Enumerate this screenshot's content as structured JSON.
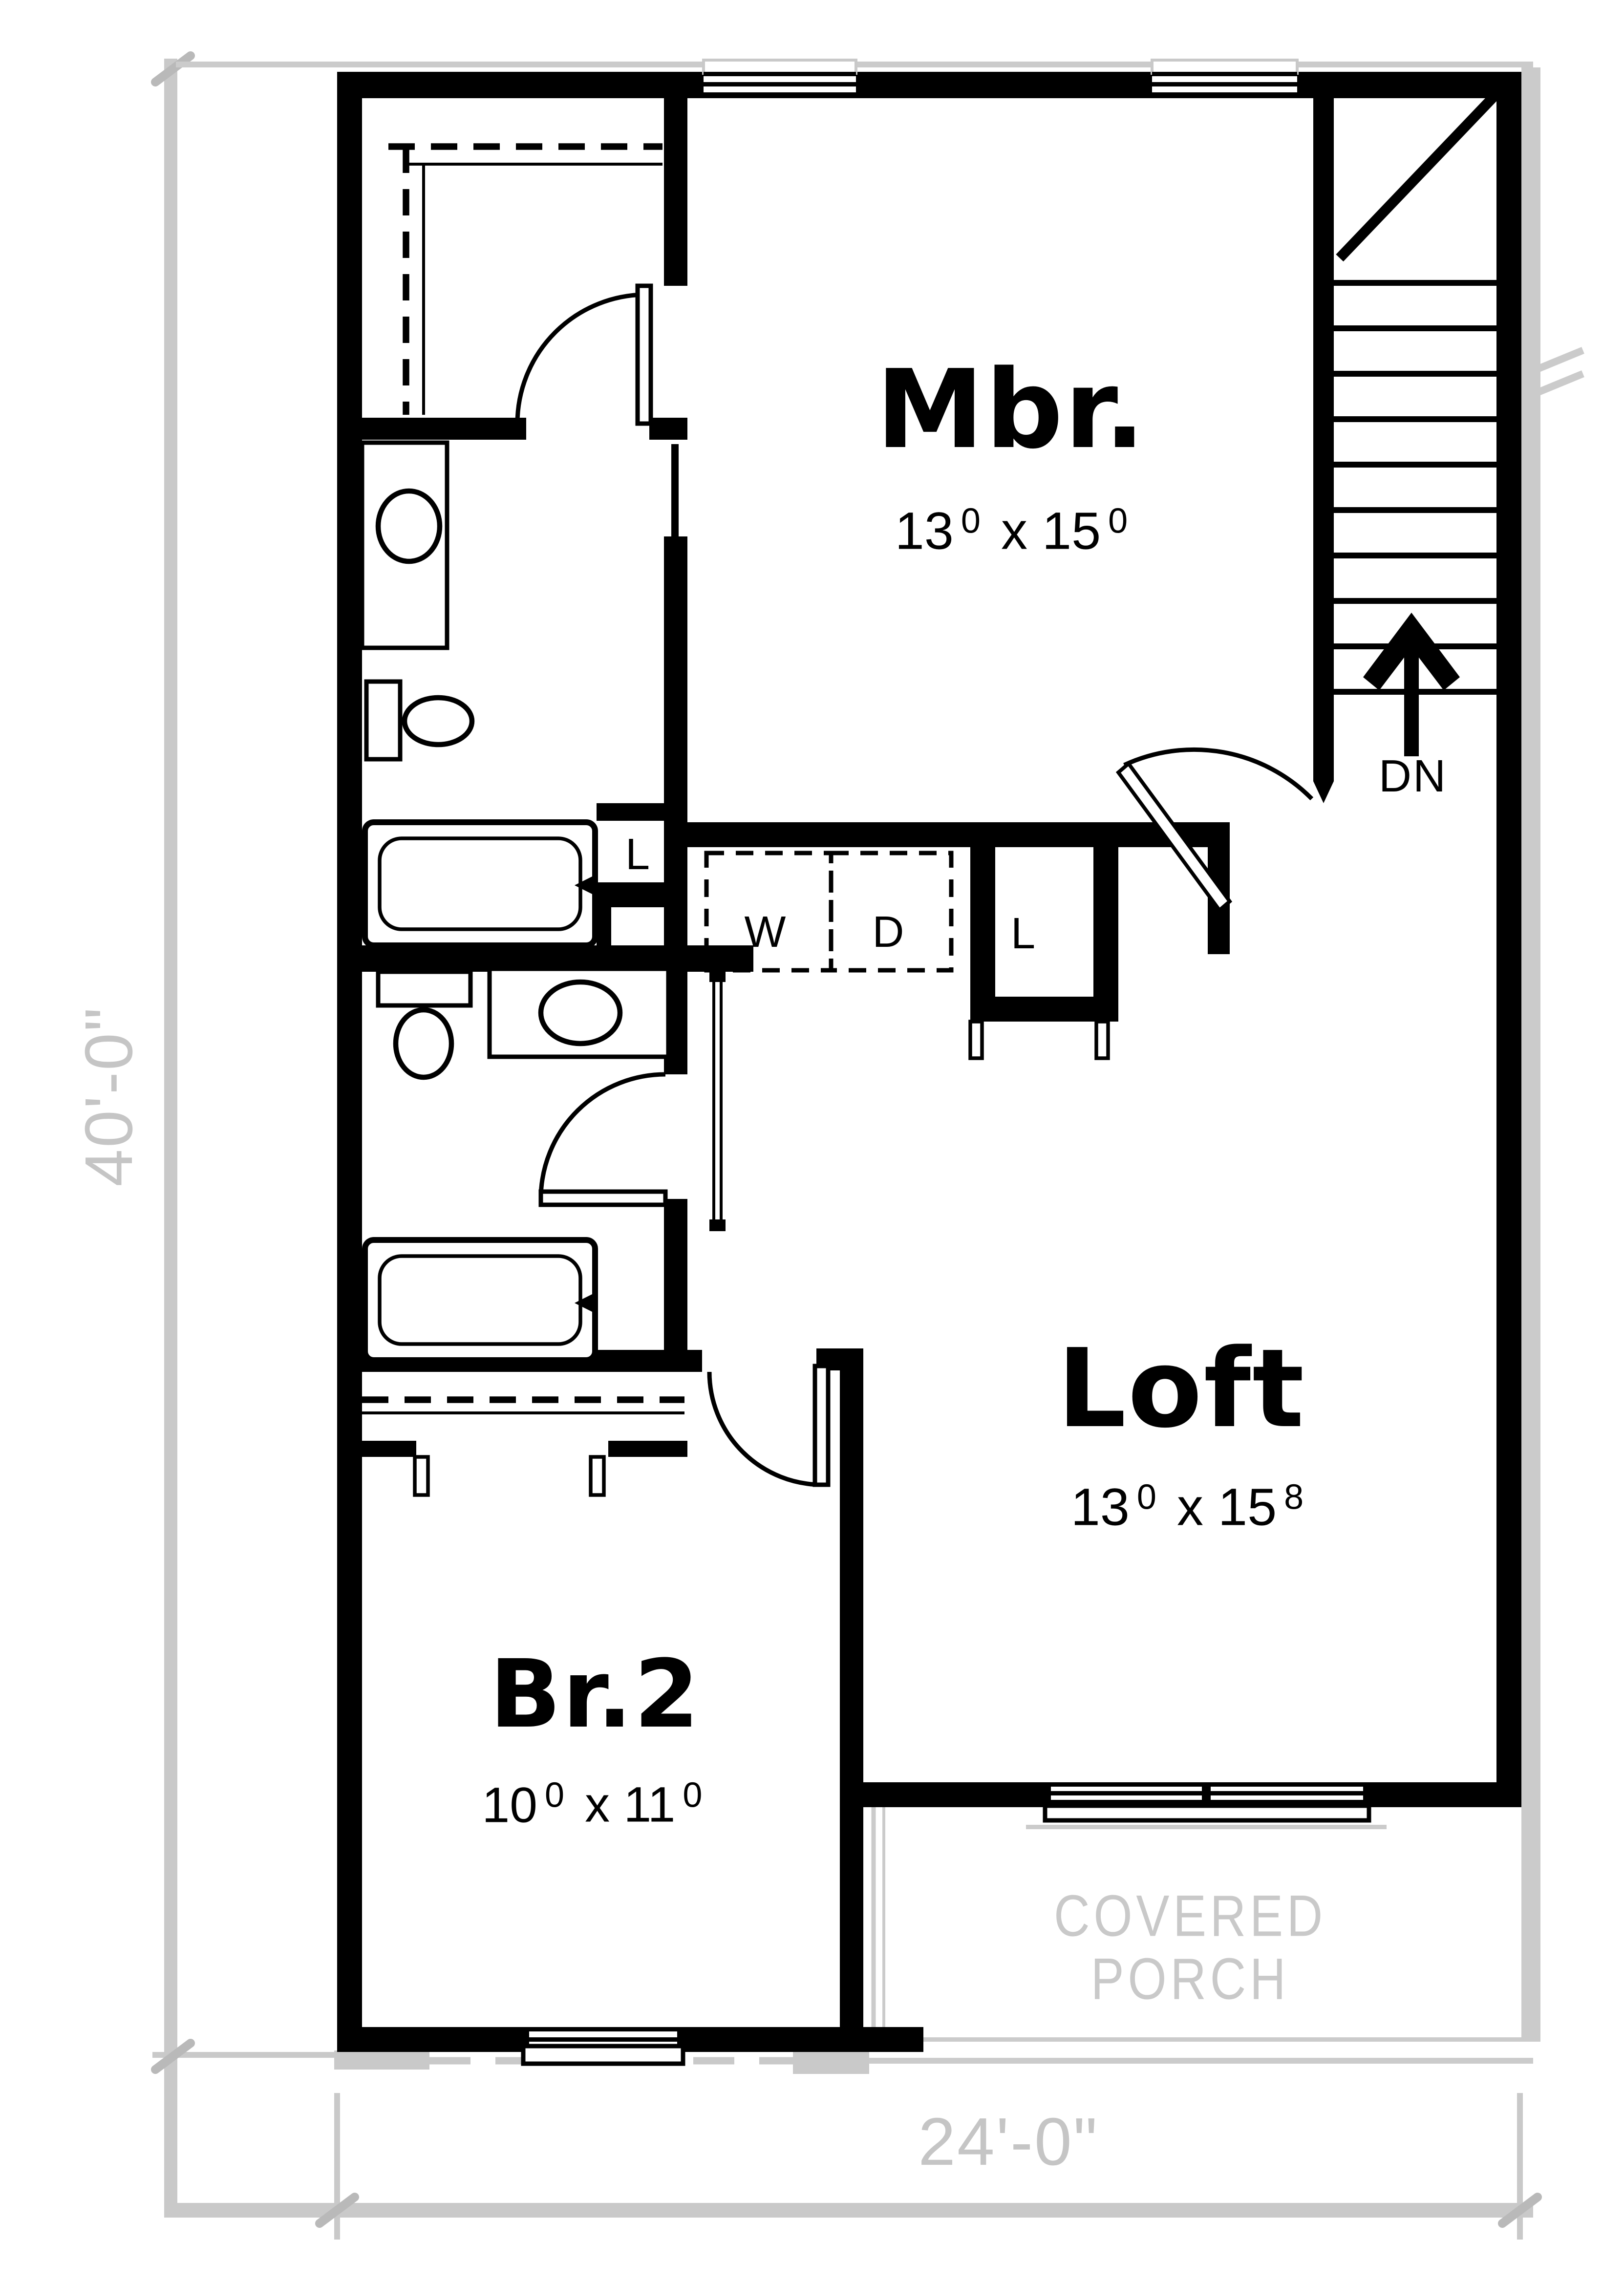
{
  "plan": {
    "title": "Second floor plan",
    "rooms": {
      "master": {
        "name": "Mbr.",
        "dim_a": "13",
        "dim_a_sup": "0",
        "dim_b": "x 15",
        "dim_b_sup": "0"
      },
      "loft": {
        "name": "Loft",
        "dim_a": "13",
        "dim_a_sup": "0",
        "dim_b": "x 15",
        "dim_b_sup": "8"
      },
      "bedroom2": {
        "name": "Br.2",
        "dim_a": "10",
        "dim_a_sup": "0",
        "dim_b": "x 11",
        "dim_b_sup": "0"
      }
    },
    "labels": {
      "stairs_down": "DN",
      "washer": "W",
      "dryer": "D",
      "linen_bath": "L",
      "linen_laundry": "L",
      "porch_line1": "COVERED",
      "porch_line2": "PORCH"
    },
    "dimensions": {
      "overall_depth": "40'-0\"",
      "overall_width": "24'-0\""
    },
    "colors": {
      "wall": "#000000",
      "dim_gray": "#c9c9c9",
      "text_gray": "#c5c5c5"
    }
  }
}
